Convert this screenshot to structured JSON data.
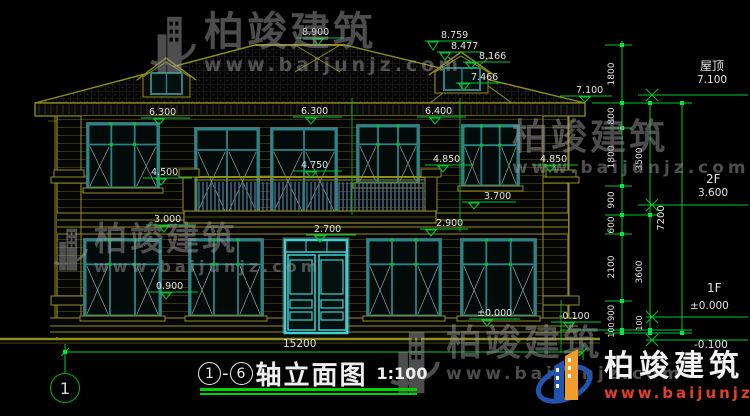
{
  "watermark": {
    "brand": "柏竣建筑",
    "url": "www.baijunjz.com"
  },
  "title": {
    "axis_start": "1",
    "axis_end": "6",
    "dash": "-",
    "name": "轴立面图",
    "scale": "1:100"
  },
  "axis_bubble": "1",
  "labels": {
    "l8900": "8.900",
    "l8759": "8.759",
    "l8477": "8.477",
    "l8166": "8.166",
    "l7466": "7.466",
    "l7100": "7.100",
    "l6300a": "6.300",
    "l6300b": "6.300",
    "l6400": "6.400",
    "l4500": "4.500",
    "l4750": "4.750",
    "l4850a": "4.850",
    "l4850b": "4.850",
    "l3700": "3.700",
    "l3000": "3.000",
    "l2900": "2.900",
    "l2700": "2.700",
    "l0900": "0.900",
    "l0000": "±0.000",
    "lm0100": "-0.100",
    "l15200": "15200"
  },
  "right": {
    "roof_label": "屋顶",
    "roof_value": "7.100",
    "f2_label": "2F",
    "f2_value": "3.600",
    "f1_label": "1F",
    "f1_value": "±0.000",
    "below_value": "-0.100",
    "chain1": [
      "1800",
      "800",
      "1800",
      "900",
      "600",
      "2100",
      "900",
      "100"
    ],
    "chain2": [
      "3500",
      "3600",
      "100"
    ],
    "chain3": [
      "7200"
    ]
  },
  "colors": {
    "background": "#000000",
    "linework_olive": "#8f8f1e",
    "dimension_green": "#00c832",
    "window_teal": "#2b8484",
    "door_cyan": "#41cfcf",
    "text_white": "#e3e3e3",
    "railing_blue": "#4e7090",
    "logo_blue": "#2253b0",
    "logo_orange": "#f09d2a",
    "logo_red": "#e04028",
    "watermark_gray": "#9a9a9a"
  }
}
